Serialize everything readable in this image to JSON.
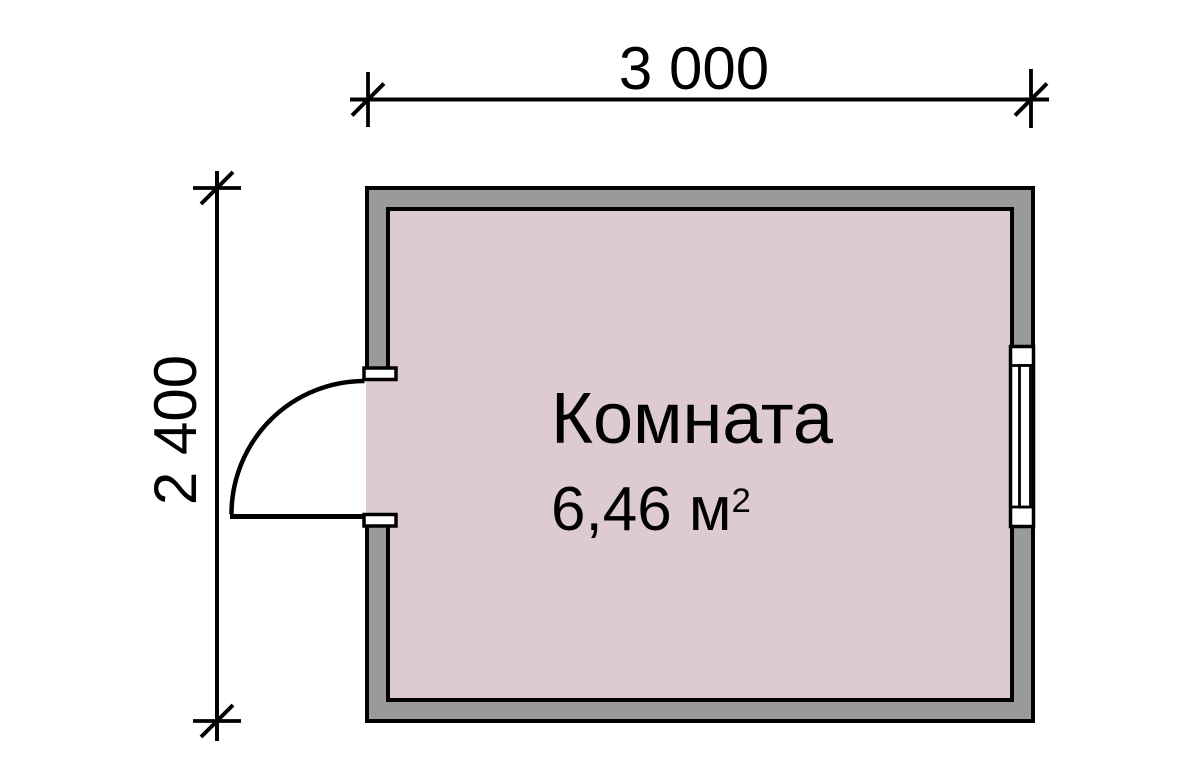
{
  "plan": {
    "room": {
      "name": "Комната",
      "area_value": "6,46 м",
      "area_exponent": "2"
    },
    "dimensions": {
      "width_label": "3 000",
      "height_label": "2 400"
    },
    "symbols": {
      "door": "door-swing-symbol",
      "window": "window-symbol"
    },
    "colors": {
      "wall_fill": "#9a9a9a",
      "room_fill": "#ddcbcf",
      "line": "#000000",
      "background": "#ffffff"
    }
  }
}
